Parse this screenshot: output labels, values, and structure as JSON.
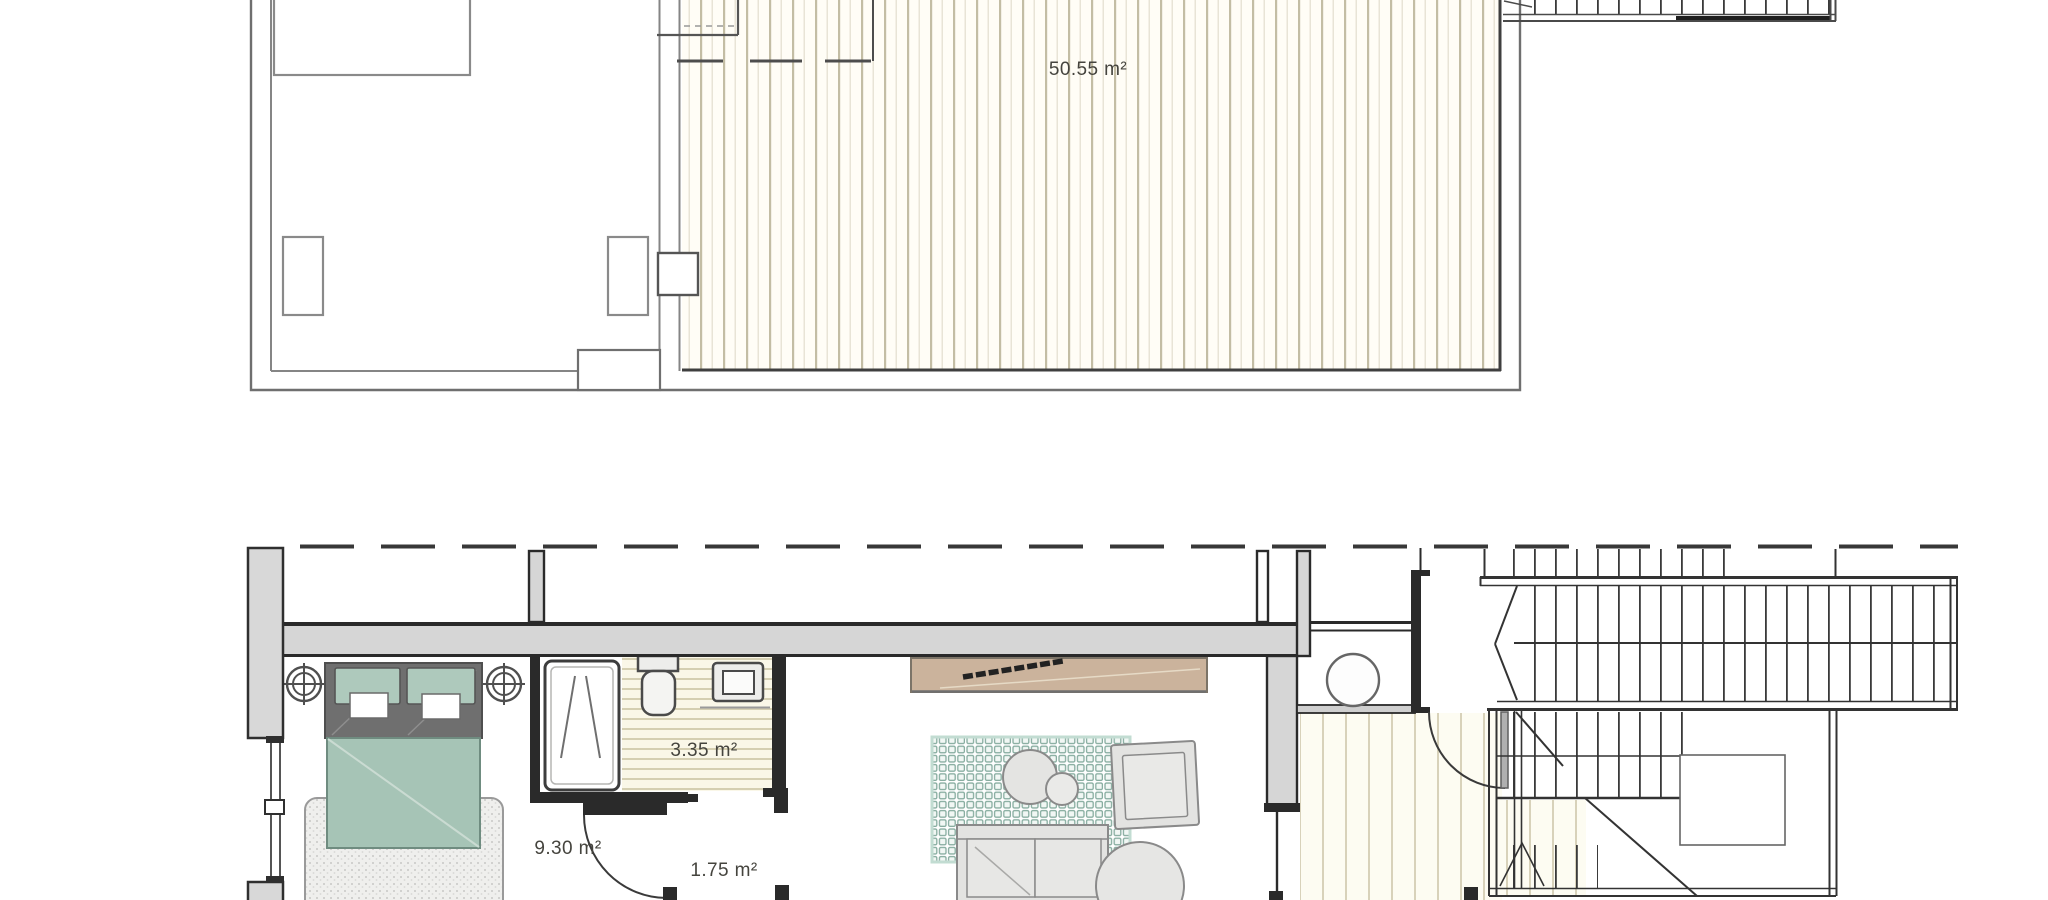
{
  "document": {
    "type": "architectural-floor-plan",
    "views": [
      "upper-level-plan",
      "lower-level-plan"
    ]
  },
  "labels": {
    "terrace_area": "50.55 m²",
    "bathroom_area": "3.35 m²",
    "bedroom_area": "9.30 m²",
    "hallway_area": "1.75 m²"
  },
  "plans": {
    "upper": {
      "rooms": [
        {
          "id": "terrace-deck",
          "area_label": "50.55 m²",
          "floor_finish": "vertical-decking-hatch"
        }
      ]
    },
    "lower": {
      "rooms": [
        {
          "id": "bedroom",
          "area_label": "9.30 m²"
        },
        {
          "id": "bathroom",
          "area_label": "3.35 m²",
          "floor_finish": "horizontal-tile-hatch"
        },
        {
          "id": "hallway",
          "area_label": "1.75 m²",
          "floor_finish": "vertical-decking-hatch"
        }
      ]
    }
  },
  "elements": {
    "fixtures": [
      "double-bed",
      "pillows",
      "bedroom-rug",
      "ceiling-light-symbols",
      "shower",
      "toilet",
      "washbasin",
      "tv-sideboard",
      "living-rug",
      "coffee-tables",
      "armchair",
      "sofa",
      "side-table",
      "water-heater",
      "entry-door-swing",
      "bedroom-door-swing",
      "staircase",
      "window",
      "roof-overhang-dashed-line"
    ]
  },
  "colors": {
    "wall_fill": "#d6d6d6",
    "wall_line": "#2a2a2a",
    "thin_wall_line": "#7d7d7d",
    "deck_hatch_line": "#c3bda4",
    "tile_hatch_line": "#d5cfb2",
    "bed_teal": "#a6c4b6",
    "pillow_teal": "#aec9bc",
    "sideboard_tan": "#cbb39c",
    "rug_grid_teal": "#86ac9f",
    "furniture_gray": "#e4e4e2",
    "label_text": "#45443e"
  }
}
